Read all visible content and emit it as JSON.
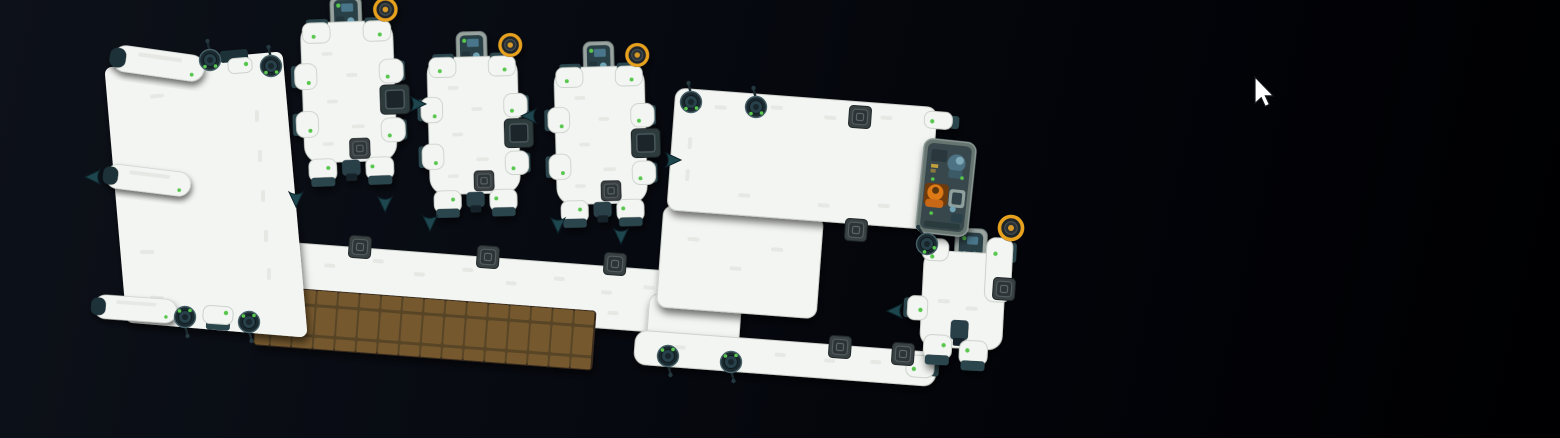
{
  "scene": {
    "name": "space-station-exterior-overview",
    "description": "Top-down exterior view of a modular white space station floating in dark space: one large hull slab with side tanks, three docked shuttles along the top, a long corridor with a brown cargo tile deck, a large platform with defense turrets and hatches, a dark boarding/airlock bay with a suited crew member, and one small shuttle at lower right. A mouse pointer hovers in empty space at upper right.",
    "visible_text": []
  },
  "colors": {
    "bg1": "#0d1119",
    "bg2": "#070a11",
    "bg3": "#030409",
    "bg4": "#000002",
    "hull": "#f3f5f2",
    "hull_stroke": "#ccd2cc",
    "pill": "#d8ddd7",
    "teal": "#2c454c",
    "teal_dark": "#1d3137",
    "turret_base": "#1b2a30",
    "turret_core": "#27404a",
    "led": "#58c84e",
    "dish_ring": "#e8a11d",
    "dish_core": "#d79a28",
    "orange": "#dd7a16",
    "orange_dark": "#c86812",
    "cockpit_frame": "#98a39f",
    "cockpit_glass": "#2b3f46",
    "screen_blue": "#49768a",
    "brown": "#75592f",
    "brown_grout": "#594527",
    "dock_frame": "#66756f",
    "dock_panel": "#37474b",
    "hatch": "#3a4143",
    "hatch_inner": "#2d3437",
    "cone": "#1d464f",
    "cursor_fill": "#ffffff"
  },
  "placement": {
    "station": "translate(0,0)",
    "corridor": "translate(256,240) rotate(4.3)",
    "platform_upper": "translate(676,88) rotate(4.3)",
    "platform_mid": "translate(664,205) rotate(4.3)",
    "platform_band": "translate(636,330) rotate(4.3)",
    "platform_join": "translate(650,293) rotate(4.3)",
    "left_module": "translate(0,0)",
    "dock_module": "translate(925,138) rotate(6)",
    "shuttle_small": "rotate(3 960 300)",
    "shuttles": [
      "translate(292,-2) rotate(-2) scale(0.92)",
      "translate(419,33) rotate(-1.5) scale(0.9)",
      "translate(546,43) rotate(-1.5) scale(0.9)"
    ],
    "tanks": [
      "translate(113,57) rotate(8) scale(0.82)",
      "translate(106,175) rotate(7) scale(0.76)",
      "translate(94,306) rotate(4) scale(0.74)"
    ],
    "turrets": [
      "translate(210,60)",
      "translate(271,66)",
      "translate(185,317) rotate(180)",
      "translate(249,322) rotate(180)",
      "translate(691,102)",
      "translate(756,107)",
      "translate(668,356) rotate(180)",
      "translate(731,362) rotate(180)",
      "translate(927,244) rotate(-20)"
    ],
    "hatches": [
      "translate(360,247) rotate(4)",
      "translate(488,257) rotate(4)",
      "translate(615,264) rotate(4)",
      "translate(860,117) rotate(4)",
      "translate(856,230) rotate(4)",
      "translate(840,347) rotate(4)",
      "translate(903,354) rotate(4)",
      "translate(1004,289) rotate(4)"
    ],
    "thruster_cones": [
      "translate(411,104)",
      "translate(536,116) rotate(180)",
      "translate(666,160)",
      "translate(296,192) rotate(90)",
      "translate(385,197) rotate(90)",
      "translate(430,216) rotate(90)",
      "translate(558,218) rotate(90)",
      "translate(621,229) rotate(90)",
      "translate(902,311) rotate(180)",
      "translate(100,177) rotate(180)"
    ],
    "dish_small_shuttle": "translate(1011,228)",
    "cursor": "translate(1255,77)"
  },
  "counts": {
    "docked_shuttles": 4,
    "defense_turrets": 9,
    "hatches": 8,
    "radar_dishes": 4,
    "side_tanks": 3,
    "crew_visible": 5
  }
}
